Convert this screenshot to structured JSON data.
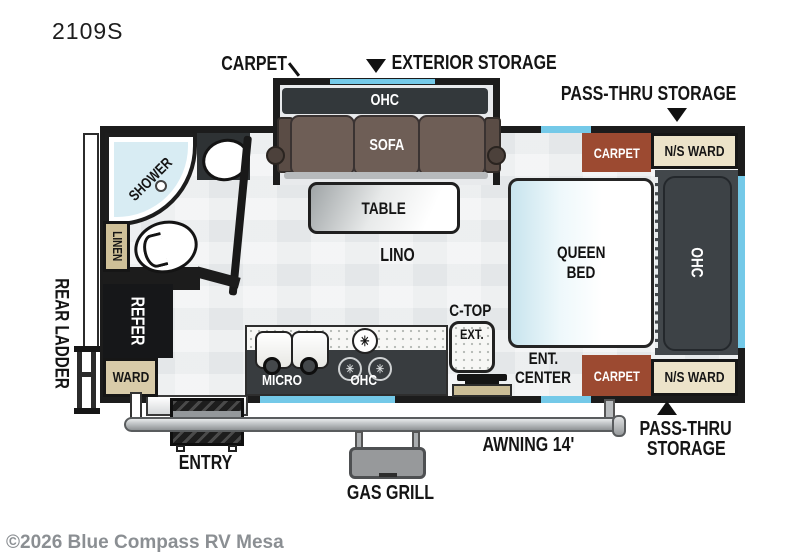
{
  "model": "2109S",
  "watermark": "©2026 Blue Compass RV Mesa",
  "callouts": {
    "carpet": "CARPET",
    "exterior_storage": "EXTERIOR STORAGE",
    "pass_thru_storage_top": "PASS-THRU STORAGE",
    "pass_thru_bottom_line1": "PASS-THRU",
    "pass_thru_bottom_line2": "STORAGE",
    "awning": "AWNING 14'",
    "gas_grill": "GAS GRILL",
    "entry": "ENTRY",
    "rear_ladder": "REAR LADDER"
  },
  "living": {
    "slide_ohc": "OHC",
    "sofa": "SOFA",
    "table": "TABLE",
    "lino": "LINO"
  },
  "galley": {
    "micro": "MICRO",
    "ohc": "OHC",
    "ctop": "C-TOP",
    "ctop_ext": "EXT.",
    "ent_line1": "ENT.",
    "ent_line2": "CENTER",
    "burner_icon": "✳"
  },
  "bath": {
    "shower": "SHOWER",
    "linen": "LINEN"
  },
  "storage": {
    "refer": "REFER",
    "ward": "WARD",
    "ns_ward_top": "N/S WARD",
    "ns_ward_bottom": "N/S WARD",
    "carpet_top": "CARPET",
    "carpet_bottom": "CARPET"
  },
  "bedroom": {
    "bed_line1": "QUEEN",
    "bed_line2": "BED",
    "ohc": "OHC"
  },
  "colors": {
    "wall": "#1c1c1c",
    "carpet_brown": "#9c4a31",
    "ward_cream": "#ece3c9",
    "cabinet_tan": "#d8cba9",
    "window_blue": "#74c9e8",
    "sofa_brown": "#6e5e56",
    "panel_dark": "#42474b",
    "floor_gray": "#e4e7e9",
    "watermark_gray": "#8b8f93"
  }
}
